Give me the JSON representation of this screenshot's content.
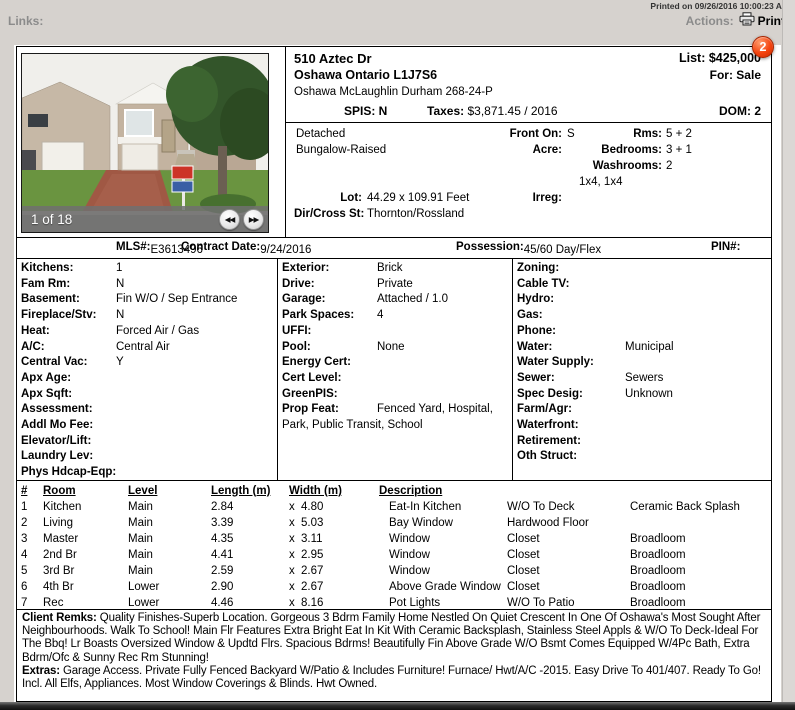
{
  "chrome": {
    "printed_on": "Printed on 09/26/2016 10:00:23 AM",
    "links_label": "Links:",
    "actions_label": "Actions:",
    "print_label": "Print",
    "badge_count": "2"
  },
  "colors": {
    "badge_red": "#f4430e",
    "photo_bar_gray": "#707070"
  },
  "photo": {
    "counter": "1 of 18",
    "prev_icon": "◀◀",
    "next_icon": "▶▶"
  },
  "header": {
    "address": "510 Aztec Dr",
    "city_line": "Oshawa Ontario L1J7S6",
    "area_line": "Oshawa McLaughlin Durham 268-24-P",
    "spis": "SPIS: N",
    "taxes_label": "Taxes:",
    "taxes_value": "$3,871.45 / 2016",
    "list": "List: $425,000",
    "for": "For: Sale",
    "dom": "DOM: 2"
  },
  "property": {
    "type1": "Detached",
    "type2": "Bungalow-Raised",
    "front_on_label": "Front On:",
    "front_on": "S",
    "acre_label": "Acre:",
    "acre": "",
    "rms_label": "Rms:",
    "rms": "5 + 2",
    "bedrooms_label": "Bedrooms:",
    "bedrooms": "3 + 1",
    "washrooms_label": "Washrooms:",
    "washrooms": "2",
    "washroom_detail": "1x4, 1x4",
    "lot_label": "Lot:",
    "lot": "44.29 x 109.91 Feet",
    "irreg_label": "Irreg:",
    "irreg": "",
    "dir_label": "Dir/Cross St:",
    "dir": "Thornton/Rossland"
  },
  "mls_row": {
    "mls_label": "MLS#:",
    "mls": "E3613496",
    "contract_label": "Contract Date:",
    "contract": "9/24/2016",
    "possession_label": "Possession:",
    "possession": "45/60 Day/Flex",
    "pin_label": "PIN#:",
    "pin": ""
  },
  "details": {
    "col1": [
      {
        "label": "Kitchens:",
        "value": "1"
      },
      {
        "label": "Fam Rm:",
        "value": "N"
      },
      {
        "label": "Basement:",
        "value": "Fin W/O / Sep Entrance"
      },
      {
        "label": "Fireplace/Stv:",
        "value": "N"
      },
      {
        "label": "Heat:",
        "value": "Forced Air / Gas"
      },
      {
        "label": "A/C:",
        "value": "Central Air"
      },
      {
        "label": "Central Vac:",
        "value": "Y"
      },
      {
        "label": "Apx Age:",
        "value": ""
      },
      {
        "label": "Apx Sqft:",
        "value": ""
      },
      {
        "label": "Assessment:",
        "value": ""
      },
      {
        "label": "Addl Mo Fee:",
        "value": ""
      },
      {
        "label": "Elevator/Lift:",
        "value": ""
      },
      {
        "label": "Laundry Lev:",
        "value": ""
      },
      {
        "label": "Phys Hdcap-Eqp:",
        "value": ""
      }
    ],
    "col2": [
      {
        "label": "Exterior:",
        "value": "Brick"
      },
      {
        "label": "Drive:",
        "value": "Private"
      },
      {
        "label": "Garage:",
        "value": "Attached / 1.0"
      },
      {
        "label": "Park Spaces:",
        "value": "4"
      },
      {
        "label": "UFFI:",
        "value": ""
      },
      {
        "label": "Pool:",
        "value": "None"
      },
      {
        "label": "Energy Cert:",
        "value": ""
      },
      {
        "label": "Cert Level:",
        "value": ""
      },
      {
        "label": "GreenPIS:",
        "value": ""
      },
      {
        "label": "Prop Feat:",
        "value": "Fenced Yard, Hospital, Park, Public Transit, School"
      }
    ],
    "col3": [
      {
        "label": "Zoning:",
        "value": ""
      },
      {
        "label": "Cable TV:",
        "value": ""
      },
      {
        "label": "Hydro:",
        "value": ""
      },
      {
        "label": "Gas:",
        "value": ""
      },
      {
        "label": "Phone:",
        "value": ""
      },
      {
        "label": "Water:",
        "value": "Municipal"
      },
      {
        "label": "Water Supply:",
        "value": ""
      },
      {
        "label": "Sewer:",
        "value": "Sewers"
      },
      {
        "label": "Spec Desig:",
        "value": "Unknown"
      },
      {
        "label": "Farm/Agr:",
        "value": ""
      },
      {
        "label": "Waterfront:",
        "value": ""
      },
      {
        "label": "Retirement:",
        "value": ""
      },
      {
        "label": "Oth Struct:",
        "value": ""
      }
    ]
  },
  "rooms": {
    "x_sep": "x",
    "headers": {
      "num": "#",
      "room": "Room",
      "level": "Level",
      "length": "Length (m)",
      "width": "Width (m)",
      "desc": "Description"
    },
    "rows": [
      {
        "num": "1",
        "room": "Kitchen",
        "level": "Main",
        "length": "2.84",
        "width": "4.80",
        "desc1": "Eat-In Kitchen",
        "desc2": "W/O To Deck",
        "desc3": "Ceramic Back Splash"
      },
      {
        "num": "2",
        "room": "Living",
        "level": "Main",
        "length": "3.39",
        "width": "5.03",
        "desc1": "Bay Window",
        "desc2": "Hardwood Floor",
        "desc3": ""
      },
      {
        "num": "3",
        "room": "Master",
        "level": "Main",
        "length": "4.35",
        "width": "3.11",
        "desc1": "Window",
        "desc2": "Closet",
        "desc3": "Broadloom"
      },
      {
        "num": "4",
        "room": "2nd Br",
        "level": "Main",
        "length": "4.41",
        "width": "2.95",
        "desc1": "Window",
        "desc2": "Closet",
        "desc3": "Broadloom"
      },
      {
        "num": "5",
        "room": "3rd Br",
        "level": "Main",
        "length": "2.59",
        "width": "2.67",
        "desc1": "Window",
        "desc2": "Closet",
        "desc3": "Broadloom"
      },
      {
        "num": "6",
        "room": "4th Br",
        "level": "Lower",
        "length": "2.90",
        "width": "2.67",
        "desc1": "Above Grade Window",
        "desc2": "Closet",
        "desc3": "Broadloom"
      },
      {
        "num": "7",
        "room": "Rec",
        "level": "Lower",
        "length": "4.46",
        "width": "8.16",
        "desc1": "Pot Lights",
        "desc2": "W/O To Patio",
        "desc3": "Broadloom"
      }
    ]
  },
  "remarks": {
    "client_label": "Client Remks:",
    "client": "Quality Finishes-Superb Location. Gorgeous 3 Bdrm Family Home Nestled On Quiet Crescent In One Of Oshawa's Most Sought After Neighbourhoods. Walk To School! Main Flr Features Extra Bright Eat In Kit With Ceramic Backsplash, Stainless Steel Appls & W/O To Deck-Ideal For The Bbq! Lr Boasts Oversized Window & Updtd Flrs. Spacious Bdrms! Beautifully Fin Above Grade W/O Bsmt Comes Equipped W/4Pc Bath, Extra Bdrm/Ofc & Sunny Rec Rm Stunning!",
    "extras_label": "Extras:",
    "extras": "Garage Access. Private Fully Fenced Backyard W/Patio & Includes Furniture! Furnace/ Hwt/A/C -2015. Easy Drive To 401/407. Ready To Go! Incl. All Elfs, Appliances. Most Window Coverings & Blinds. Hwt Owned."
  }
}
